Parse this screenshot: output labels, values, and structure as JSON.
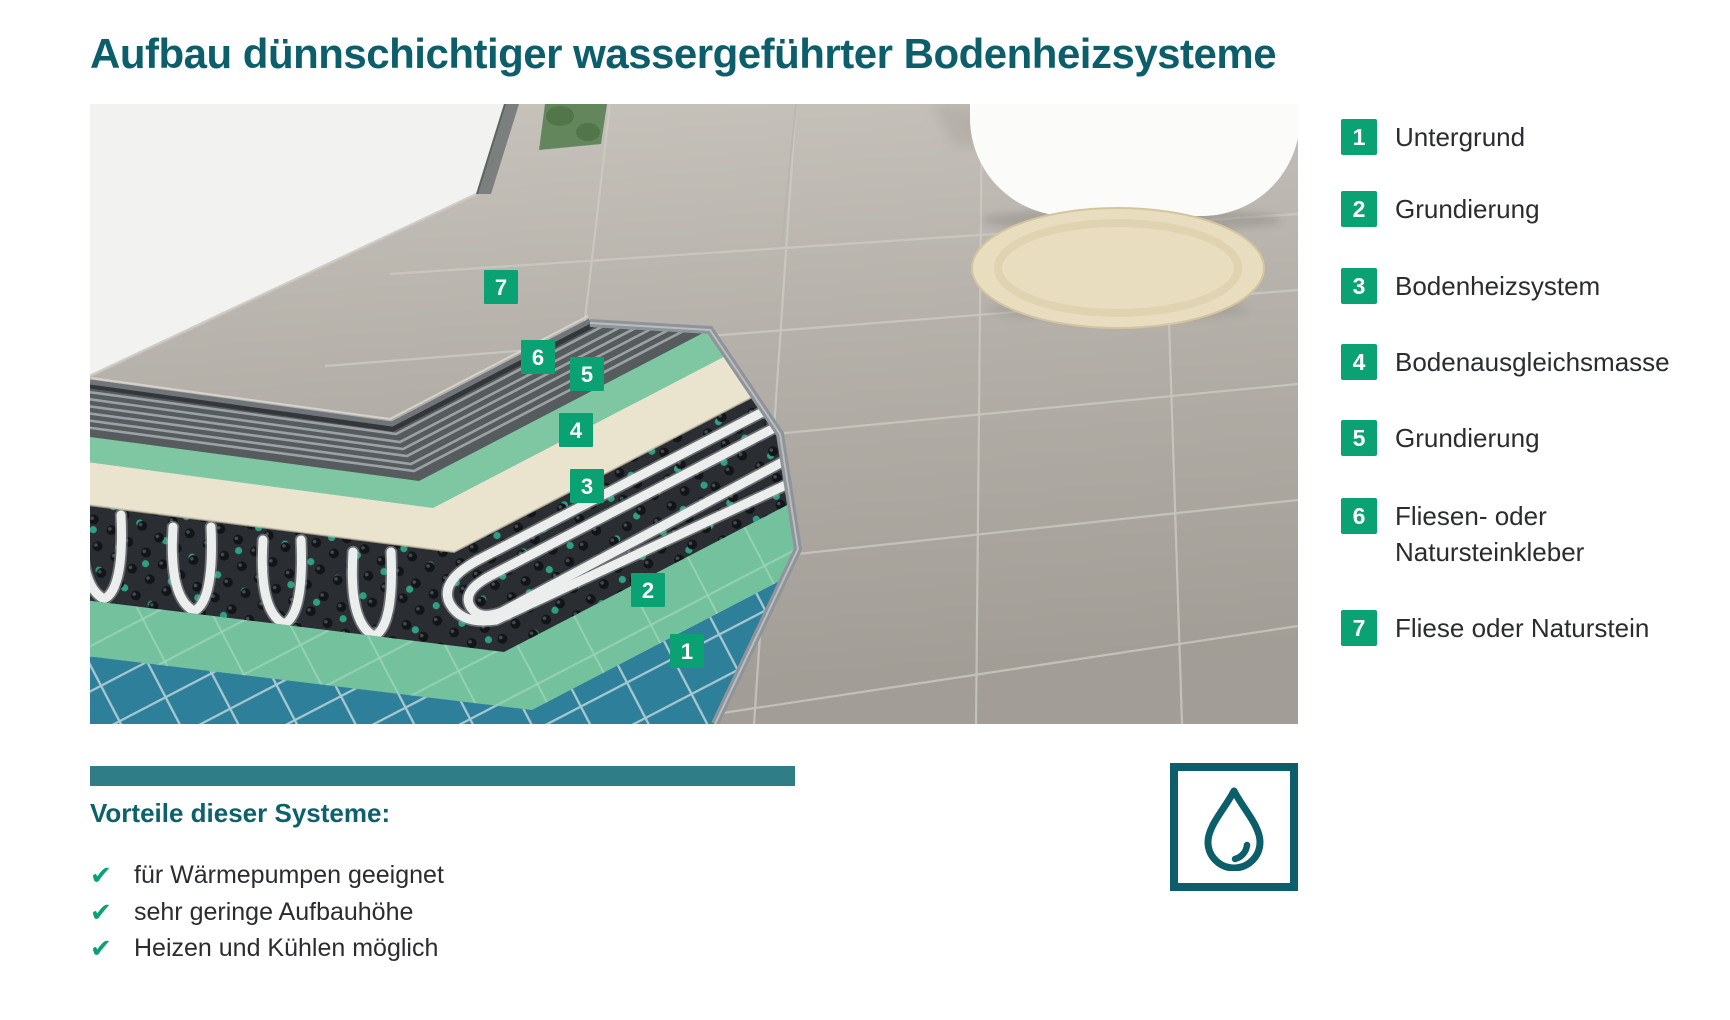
{
  "title": "Aufbau dünnschichtiger wassergeführter Bodenheizsysteme",
  "legend": {
    "items": [
      {
        "number": "1",
        "label": "Untergrund"
      },
      {
        "number": "2",
        "label": "Grundierung"
      },
      {
        "number": "3",
        "label": "Bodenheizsystem"
      },
      {
        "number": "4",
        "label": "Bodenausgleichsmasse"
      },
      {
        "number": "5",
        "label": "Grundierung"
      },
      {
        "number": "6",
        "label": "Fliesen- oder",
        "label2": "Natursteinkleber"
      },
      {
        "number": "7",
        "label": "Fliese oder Naturstein"
      }
    ]
  },
  "diagram": {
    "description": "cutaway-of-thin-hydronic-floor-heating-layers-in-bathroom",
    "tags": [
      {
        "number": "7"
      },
      {
        "number": "6"
      },
      {
        "number": "5"
      },
      {
        "number": "4"
      },
      {
        "number": "3"
      },
      {
        "number": "2"
      },
      {
        "number": "1"
      }
    ]
  },
  "advantages": {
    "heading": "Vorteile dieser Systeme:",
    "check_icon": "✔",
    "items": [
      "für Wärmepumpen geeignet",
      "sehr geringe Aufbauhöhe",
      "Heizen und Kühlen möglich"
    ]
  },
  "footer_icon": "water-drop-icon",
  "colors": {
    "heading_teal": "#0b5e6a",
    "bar_teal": "#2e7d87",
    "tag_green": "#0aa173",
    "check_green": "#0aa173",
    "blue_tile": "#2e7f99",
    "green_primer": "#73c19d",
    "cream_leveling": "#eae4cf",
    "mat_black": "#2a2e32",
    "floor_gray": "#b3afa8"
  }
}
